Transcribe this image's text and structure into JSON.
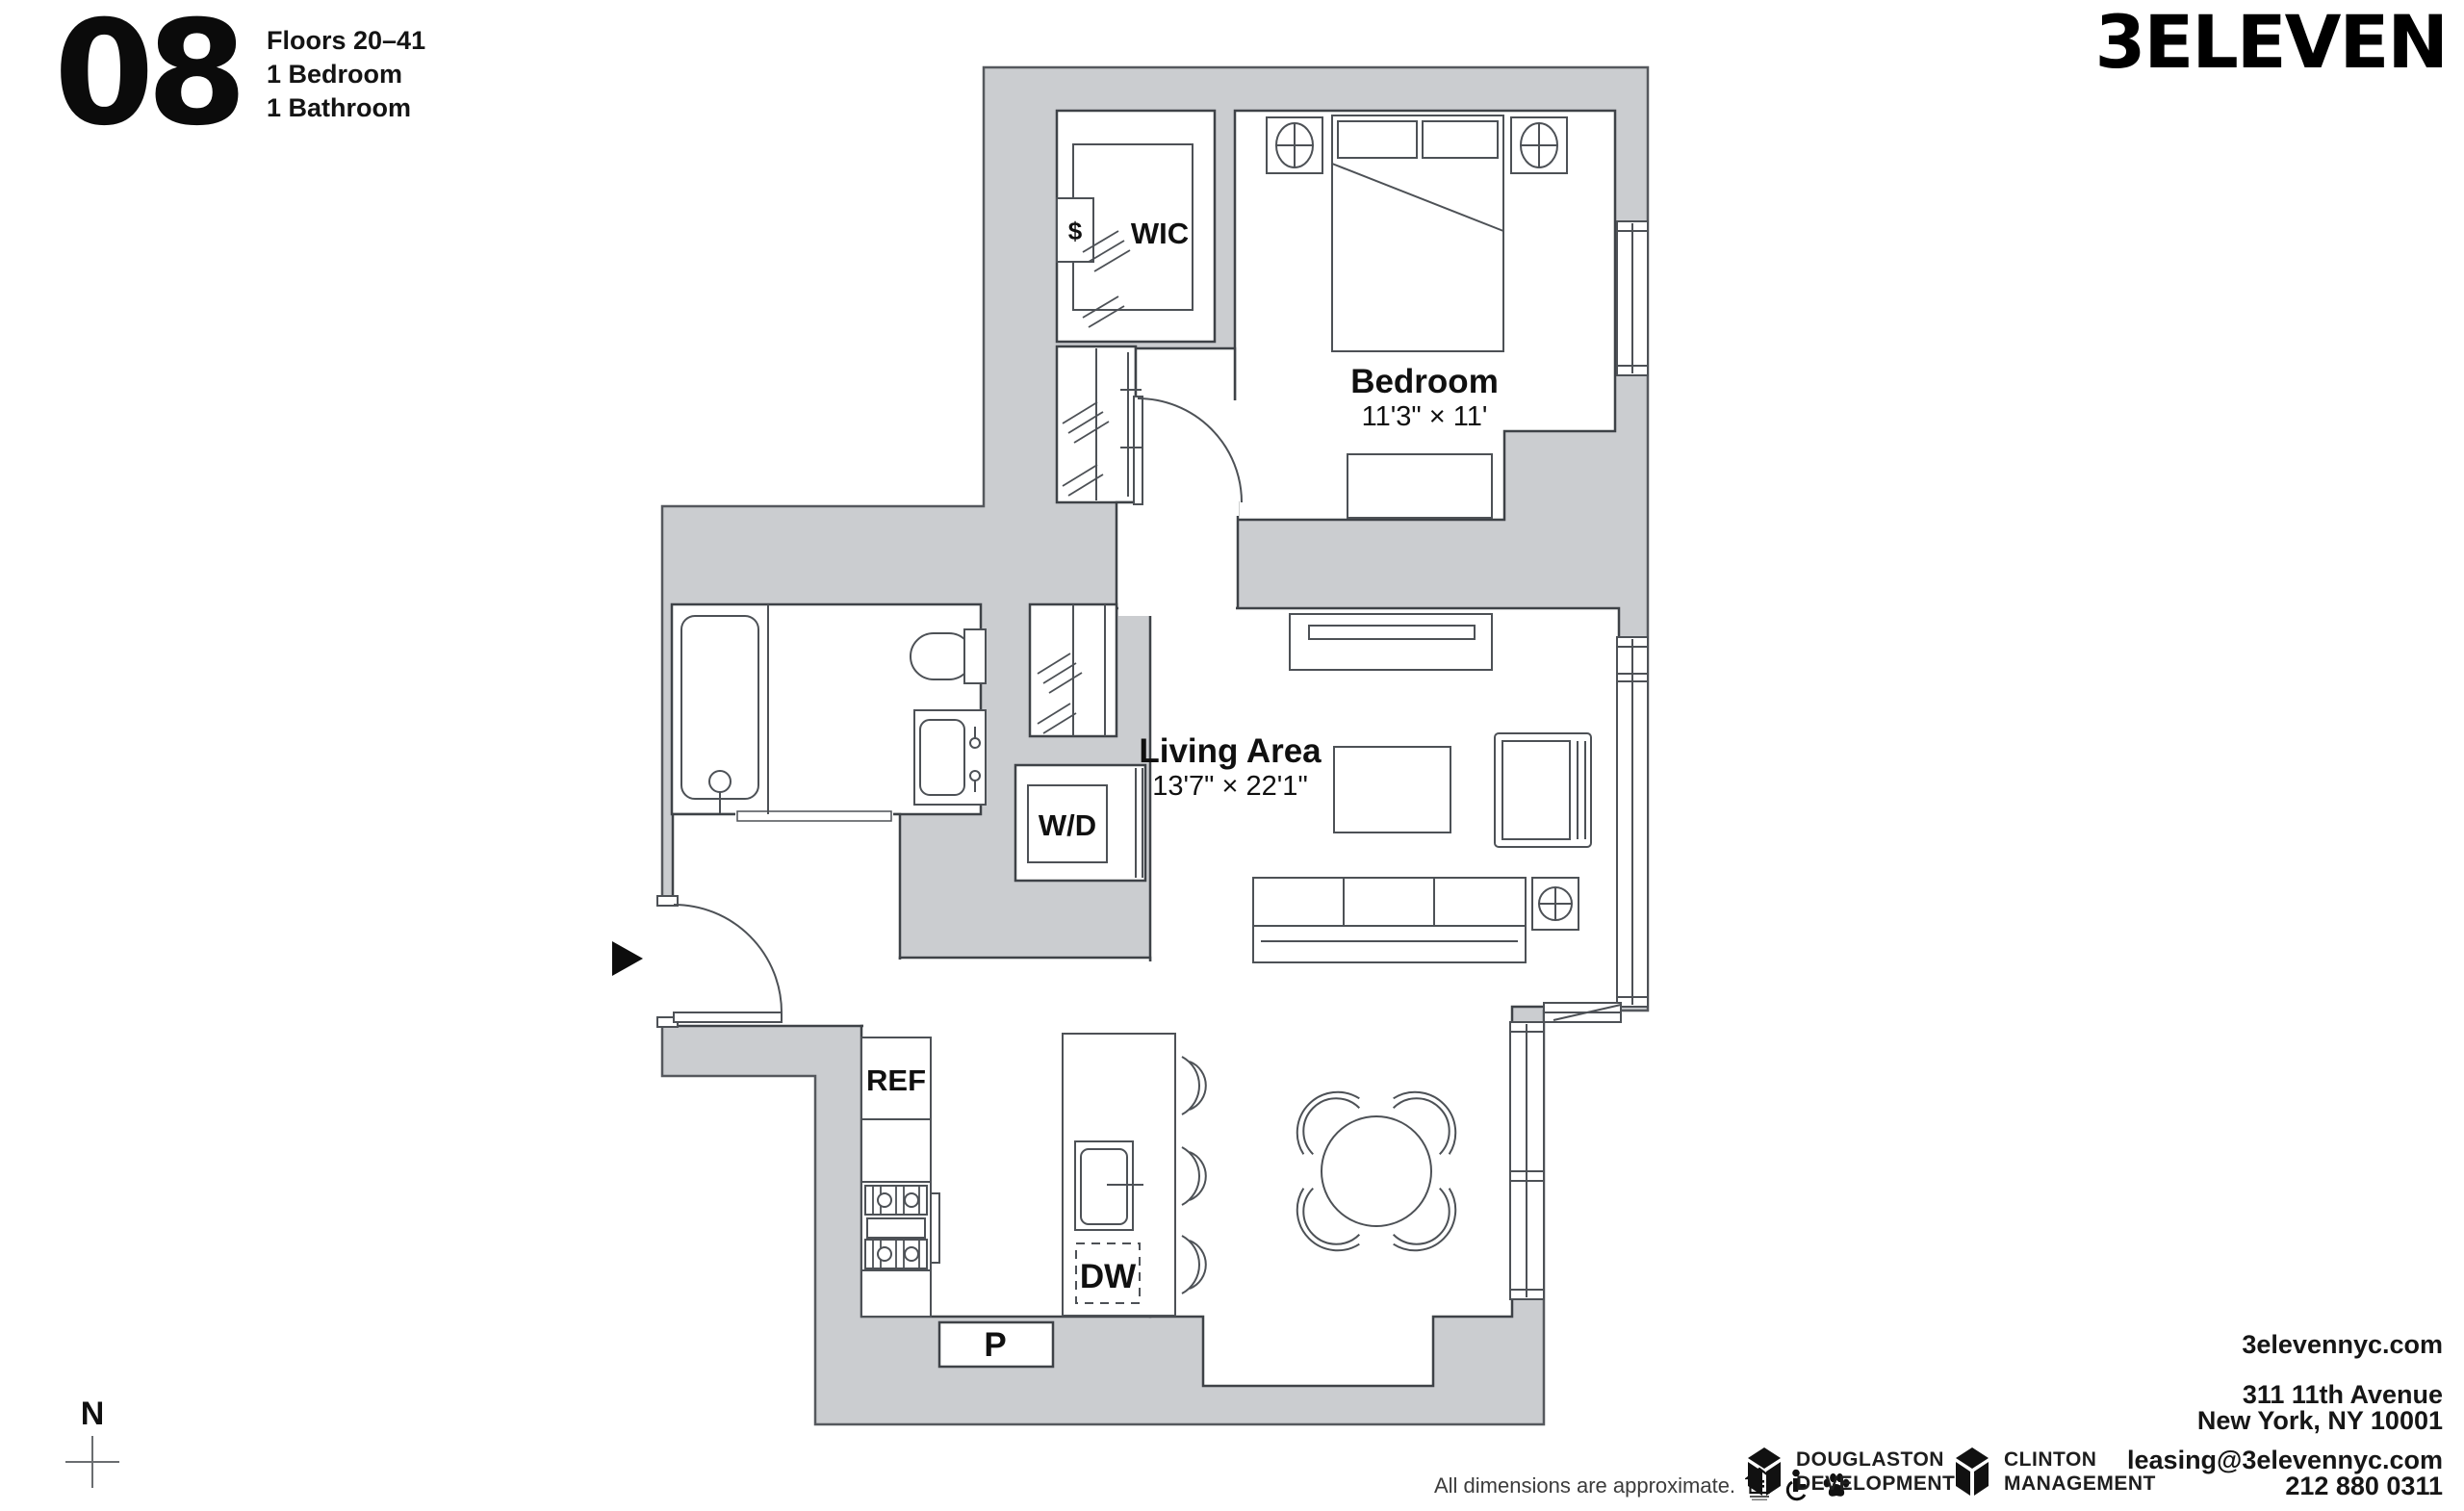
{
  "page": {
    "unit_number": "08",
    "floors": "Floors 20–41",
    "bedrooms": "1 Bedroom",
    "bathrooms": "1 Bathroom",
    "logo": "3ELEVEN",
    "compass_n": "N"
  },
  "plan": {
    "wall_color": "#cbcdd0",
    "line_color": "#3e4247",
    "labels": {
      "wic": "WIC",
      "safe": "$",
      "bedroom_name": "Bedroom",
      "bedroom_dims": "11'3\" × 11'",
      "living_name": "Living Area",
      "living_dims": "13'7\" × 22'1\"",
      "washer_dryer": "W/D",
      "fridge": "REF",
      "dishwasher": "DW",
      "pantry": "P"
    }
  },
  "footer": {
    "disclaimer": "All dimensions are approximate.",
    "icons": [
      "equal-housing-icon",
      "accessibility-icon",
      "pet-friendly-icon"
    ],
    "developer": {
      "line1": "DOUGLASTON",
      "line2": "DEVELOPMENT"
    },
    "management": {
      "line1": "CLINTON",
      "line2": "MANAGEMENT"
    }
  },
  "contact": {
    "website": "3elevennyc.com",
    "address1": "311 11th Avenue",
    "address2": "New York, NY 10001",
    "email": "leasing@3elevennyc.com",
    "phone": "212 880 0311"
  }
}
